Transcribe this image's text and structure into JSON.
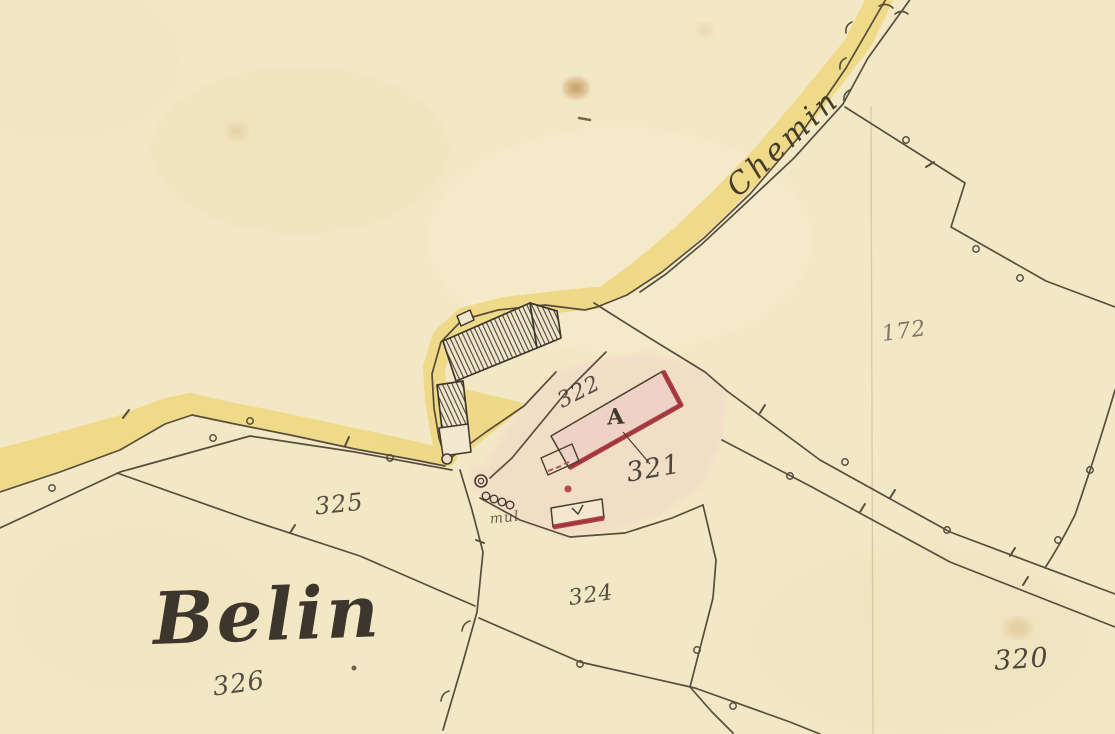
{
  "title": "Cadastral map detail - Belin",
  "map": {
    "place_name": "Belin",
    "road_name": "Chemin",
    "annotation_small": "mul",
    "building_letter": "A",
    "parcel_numbers": {
      "p172": "172",
      "p320": "320",
      "p321": "321",
      "p322": "322",
      "p324": "324",
      "p325": "325",
      "p326": "326"
    },
    "colors": {
      "paper": "#f3e8c6",
      "road_yellow": "#ecd77d",
      "ink": "#4c4133",
      "label_ink": "#3c362c",
      "building_red": "#a5303a",
      "parcel_pink_wash": "#f1d6c8",
      "building_pink": "#eed2c5",
      "stain_brown": "#c99a5f"
    }
  }
}
